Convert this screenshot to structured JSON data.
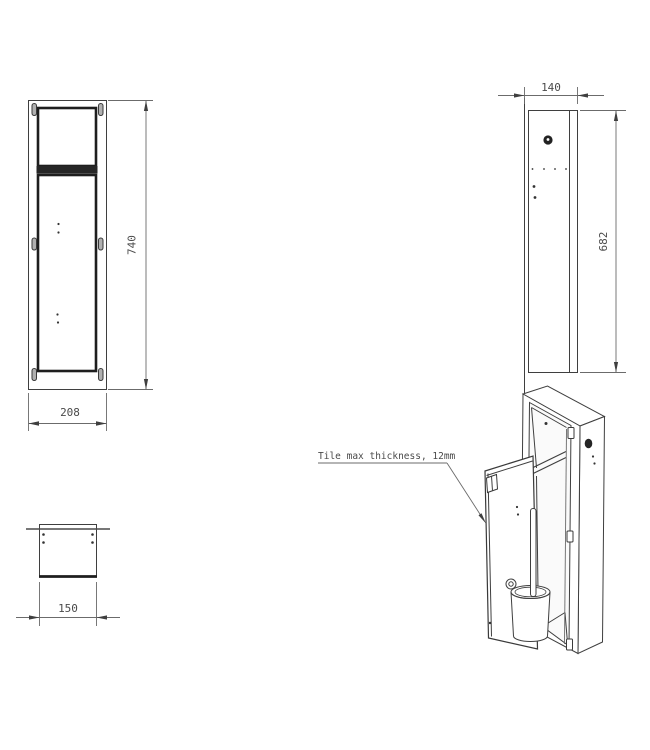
{
  "views": {
    "front": {
      "height_dim": "740",
      "width_dim": "208"
    },
    "side": {
      "depth_dim": "140",
      "height_dim": "682"
    },
    "top": {
      "width_dim": "150"
    }
  },
  "annotation": {
    "tile_note": "Tile max thickness, 12mm"
  },
  "colors": {
    "line": "#3f3f3f",
    "dim": "#6b6b6b",
    "text": "#4a4a4a",
    "background": "#ffffff"
  }
}
